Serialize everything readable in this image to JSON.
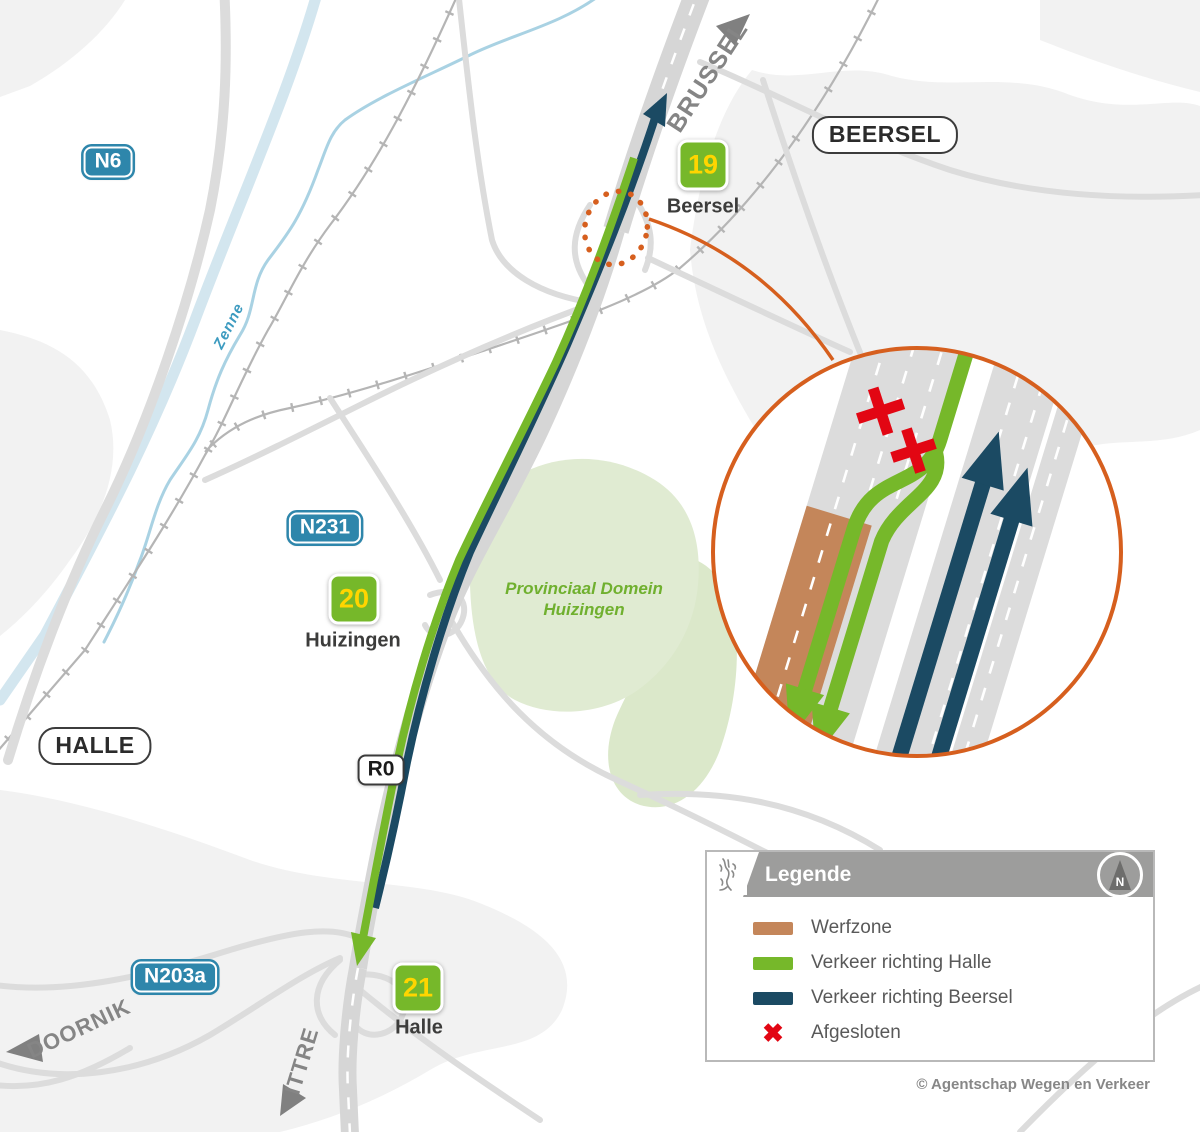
{
  "map": {
    "badges": {
      "n6": "N6",
      "n231": "N231",
      "n203a": "N203a",
      "r0": "R0"
    },
    "towns": {
      "beersel": "BEERSEL",
      "halle": "HALLE"
    },
    "directions": {
      "brussel": "BRUSSEL",
      "doornik": "DOORNIK",
      "ittre": "ITTRE"
    },
    "exits": [
      {
        "number": "19",
        "name": "Beersel"
      },
      {
        "number": "20",
        "name": "Huizingen"
      },
      {
        "number": "21",
        "name": "Halle"
      }
    ],
    "river": "Zenne",
    "area_line1": "Provinciaal Domein",
    "area_line2": "Huizingen"
  },
  "legend": {
    "title": "Legende",
    "compass_label": "N",
    "items": [
      {
        "label": "Werfzone",
        "color": "#c4865a",
        "swatch": "bar"
      },
      {
        "label": "Verkeer richting Halle",
        "color": "#76b82a",
        "swatch": "bar"
      },
      {
        "label": "Verkeer richting Beersel",
        "color": "#1b4a63",
        "swatch": "bar"
      },
      {
        "label": "Afgesloten",
        "color": "#e20613",
        "swatch": "x",
        "glyph": "✖"
      }
    ]
  },
  "copyright": "© Agentschap Wegen en Verkeer",
  "colors": {
    "traffic_halle_green": "#76b82a",
    "traffic_beersel_blue": "#1b4a63",
    "werfzone_brown": "#c4865a",
    "closed_red": "#e20613",
    "highlight_orange": "#d65f1e",
    "route_badge_blue": "#2e86ab",
    "exit_number_yellow": "#ffd500"
  }
}
